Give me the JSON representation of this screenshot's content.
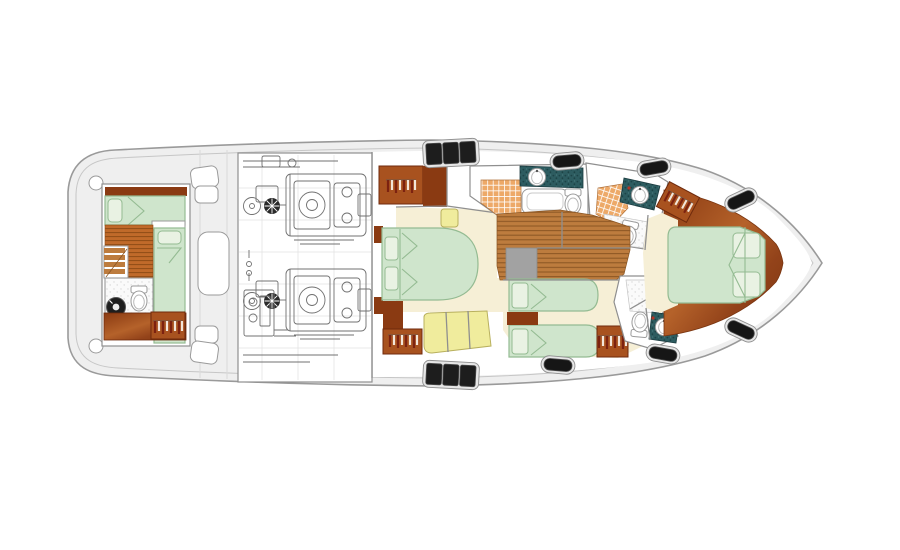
{
  "canvas": {
    "width": 900,
    "height": 550,
    "background": "#ffffff"
  },
  "palette": {
    "hull_fill": "#efefef",
    "hull_stroke": "#9a9a9a",
    "inner_line": "#c6c6c6",
    "deck_line": "#dadada",
    "room_fill": "#ffffff",
    "wall": "#8f8f8f",
    "bed_fill": "#cfe5cc",
    "bed_stroke": "#94bb92",
    "pillow_fill": "#e9f2e3",
    "carpet": "#f6efd6",
    "sofa_fill": "#f0ec9d",
    "sofa_stroke": "#b8b05e",
    "wood_orange": "#c06a2a",
    "wood_orange_line": "#8f4c16",
    "plank": "#bd7c3e",
    "plank_line": "#8a5523",
    "stair_gray": "#a2a2a2",
    "mahogany_dark": "#8a3a12",
    "mahogany_mid": "#b5622a",
    "wardrobe": "#a8521f",
    "wardrobe_edge": "#6f2a0c",
    "hanger_light": "#f2e6da",
    "hanger_dark": "#7c2210",
    "tile": "#eda968",
    "tile_line": "#ffffff",
    "teal": "#2d5c60",
    "teal_dot": "#1d4346",
    "fixture": "#ffffff",
    "fixture_stroke": "#9a9a9a",
    "speckle_bg": "#fafafa",
    "speckle_dot": "#d8d8d8",
    "engine_line": "#707070",
    "engine_dark": "#2a2a2a",
    "hatch_frame": "#e6e6e6",
    "hatch_frame_stroke": "#8f8f8f",
    "hatch_glass": "#1d1d1d",
    "hatch_glass_edge": "#4a4a4a",
    "window_black": "#161616",
    "accent_red": "#b03425"
  },
  "counts": {
    "deck_hatches_3pane": 2,
    "side_windows": 6,
    "engines": 2,
    "double_beds": 2,
    "single_beds": 4,
    "heads": 4,
    "wardrobes": 5
  }
}
